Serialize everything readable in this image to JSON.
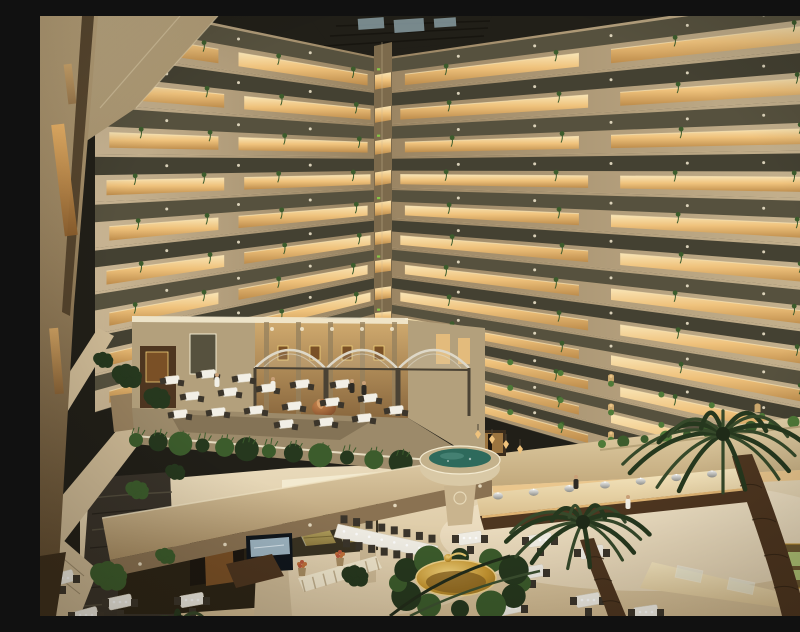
{
  "meta": {
    "type": "photograph",
    "scene": "Hotel atrium interior: a dozen floors of balconies with warm cove lighting and hanging vines rise above a mezzanine restaurant terrace with arched pergolas and a stone spa bowl, overlooking a ground-floor buffet dining hall with palm trees, a golden fountain, escalators and a stacked-stone water wall."
  },
  "palette": {
    "wall_light": "#cdb995",
    "wall_mid": "#b3a07c",
    "wall_dark": "#94805e",
    "wall_deep": "#7c6a4c",
    "glow_top": "#f9e4b4",
    "glow_mid": "#efc27c",
    "glow_deep": "#bd8c4b",
    "glow_pale": "#f3ead0",
    "glass_dark": "#444132",
    "glass_olive": "#56513e",
    "ceiling": "#211f18",
    "sky_glint": "#8fa4aa",
    "plant_dark": "#26381e",
    "plant_mid": "#3c5c2c",
    "plant_light": "#4f7a38",
    "marble_light": "#f0e4c8",
    "marble_warm": "#d2bb92",
    "wood": "#7a5026",
    "wood_dark": "#4e3620",
    "wood_deep": "#2f2213",
    "stone_dark": "#39332a",
    "stone_mid": "#57503f",
    "water_teal": "#2e6a5c",
    "water_light": "#4e8a7c",
    "gold": "#c6952f",
    "gold_light": "#f2d37c",
    "gold_dark": "#7c5a1a",
    "copper": "#b0713f",
    "copper_dark": "#6e3f22",
    "white_soft": "#f2efe6",
    "chair_dark": "#3b352b",
    "skin": "#c9a078",
    "green_sign": "#86c649",
    "glass_green": "#b5cd7c",
    "carpet": "#847356",
    "terrace": "#9c8a6a",
    "soffit": "#8a7252",
    "under_dark": "#2c2416",
    "pergola": "#ded8c8",
    "metal": "#4a4234"
  },
  "walls": {
    "corner_x": 342,
    "left": {
      "x_outer": 55,
      "outer": [
        -18,
        36,
        88,
        138,
        186,
        232,
        276,
        318,
        358,
        396
      ],
      "corner": [
        42,
        76,
        109,
        141,
        172,
        202,
        231,
        259,
        286,
        308
      ]
    },
    "right": {
      "x_outer": 800,
      "outer": [
        -25,
        30,
        83,
        134,
        183,
        230,
        275,
        318,
        359,
        398,
        435,
        470,
        503
      ],
      "corner": [
        42,
        76,
        109,
        141,
        172,
        202,
        231,
        259,
        286,
        308,
        330,
        351,
        371
      ]
    },
    "floors_left": 9,
    "floors_right": 12
  },
  "mezzanine": {
    "tables": [
      [
        132,
        364
      ],
      [
        168,
        358
      ],
      [
        204,
        362
      ],
      [
        152,
        380
      ],
      [
        190,
        376
      ],
      [
        228,
        372
      ],
      [
        262,
        368
      ],
      [
        140,
        398
      ],
      [
        178,
        396
      ],
      [
        216,
        394
      ],
      [
        254,
        390
      ],
      [
        292,
        386
      ],
      [
        302,
        368
      ],
      [
        330,
        382
      ],
      [
        246,
        408
      ],
      [
        286,
        406
      ],
      [
        324,
        402
      ],
      [
        356,
        394
      ]
    ],
    "lanterns": [
      [
        438,
        418
      ],
      [
        452,
        423
      ],
      [
        466,
        428
      ],
      [
        480,
        433
      ]
    ],
    "hedge_path": [
      [
        96,
        424
      ],
      [
        240,
        436
      ],
      [
        362,
        446
      ],
      [
        438,
        452
      ]
    ]
  },
  "ground": {
    "tables": [
      [
        22,
        562,
        -15
      ],
      [
        80,
        586,
        -12
      ],
      [
        152,
        584,
        -10
      ],
      [
        46,
        599,
        -15
      ],
      [
        430,
        522,
        -8
      ],
      [
        500,
        524,
        -8
      ],
      [
        552,
        536,
        -8
      ],
      [
        492,
        556,
        -10
      ],
      [
        548,
        584,
        -10
      ],
      [
        606,
        596,
        -8
      ],
      [
        470,
        592,
        -12
      ]
    ],
    "long_table": {
      "x0": 298,
      "y0": 508,
      "x1": 398,
      "y1": 530,
      "chairs": 8
    },
    "buffet_domes": 7
  },
  "palms": [
    {
      "cx": 683,
      "cy": 418,
      "r": 100,
      "fronds": 16
    },
    {
      "cx": 543,
      "cy": 506,
      "r": 80,
      "fronds": 14
    },
    {
      "cx": 140,
      "cy": 606,
      "r": 46,
      "fronds": 7
    }
  ],
  "people": [
    [
      233,
      370,
      "light"
    ],
    [
      312,
      372,
      "dark"
    ],
    [
      324,
      374,
      "dark"
    ],
    [
      177,
      366,
      "light"
    ],
    [
      588,
      488,
      "light"
    ],
    [
      536,
      468,
      "dark"
    ]
  ],
  "plants": {
    "stone_wall": [
      [
        98,
        474,
        14
      ],
      [
        70,
        560,
        22
      ],
      [
        126,
        540,
        12
      ]
    ],
    "mid_left": [
      [
        88,
        360,
        18
      ],
      [
        118,
        382,
        16
      ],
      [
        64,
        344,
        12
      ],
      [
        136,
        456,
        12
      ],
      [
        316,
        560,
        16
      ]
    ],
    "fountain_ring": 12
  }
}
